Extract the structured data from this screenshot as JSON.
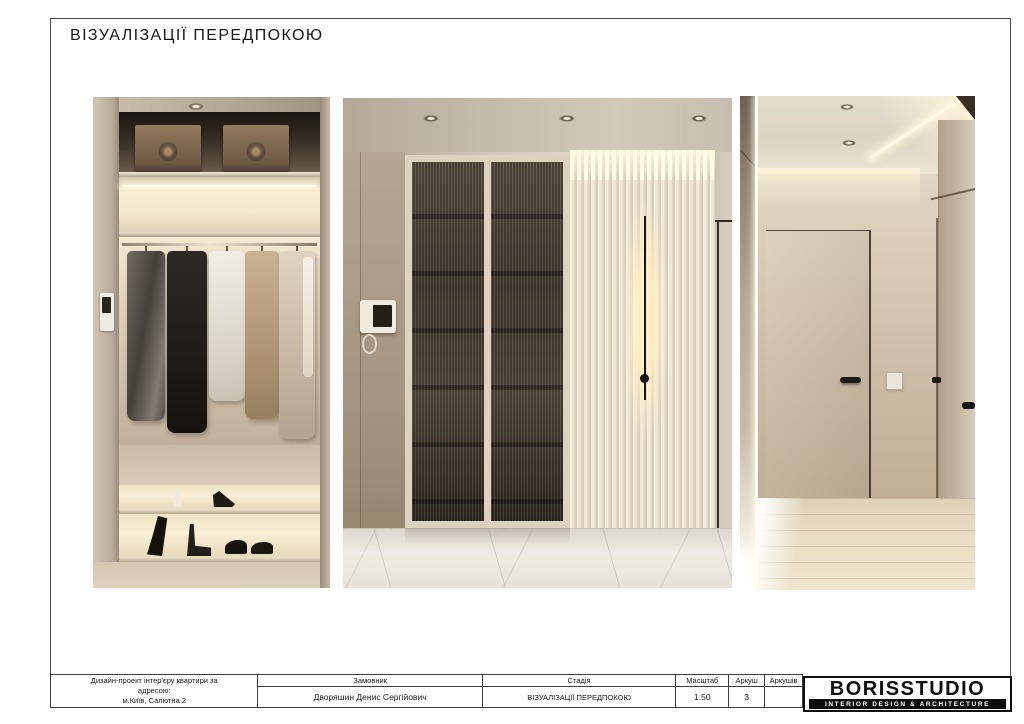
{
  "header": {
    "title": "ВІЗУАЛІЗАЦІЇ ПЕРЕДПОКОЮ"
  },
  "renders": [
    {
      "name": "closet-visualization"
    },
    {
      "name": "hallway-visualization"
    },
    {
      "name": "corridor-visualization"
    }
  ],
  "titleblock": {
    "project_lines": [
      "Дизайн-проект інтер'єру квартири за",
      "адресою:",
      "м.Київ, Салютна 2"
    ],
    "customer_label": "Замовник",
    "customer_value": "Дворяшин Денис Сергійович",
    "stage_label": "Стадія",
    "stage_value": "ВІЗУАЛІЗАЦІЇ ПЕРЕДПОКОЮ",
    "scale_label": "Масштаб",
    "scale_value": "1:50",
    "sheet_label": "Аркуш",
    "sheet_value": "3",
    "sheets_label": "Аркушів",
    "sheets_value": ""
  },
  "logo": {
    "studio_name": "BORISSTUDIO",
    "tagline": "INTERIOR DESIGN & ARCHITECTURE"
  },
  "colors": {
    "page_border": "#4a4a4a",
    "warm_glow": "#f7ecd2",
    "wall_beige": "#c9bbaa",
    "glass_brown": "#43392e",
    "logo_black": "#0d0d0d"
  }
}
